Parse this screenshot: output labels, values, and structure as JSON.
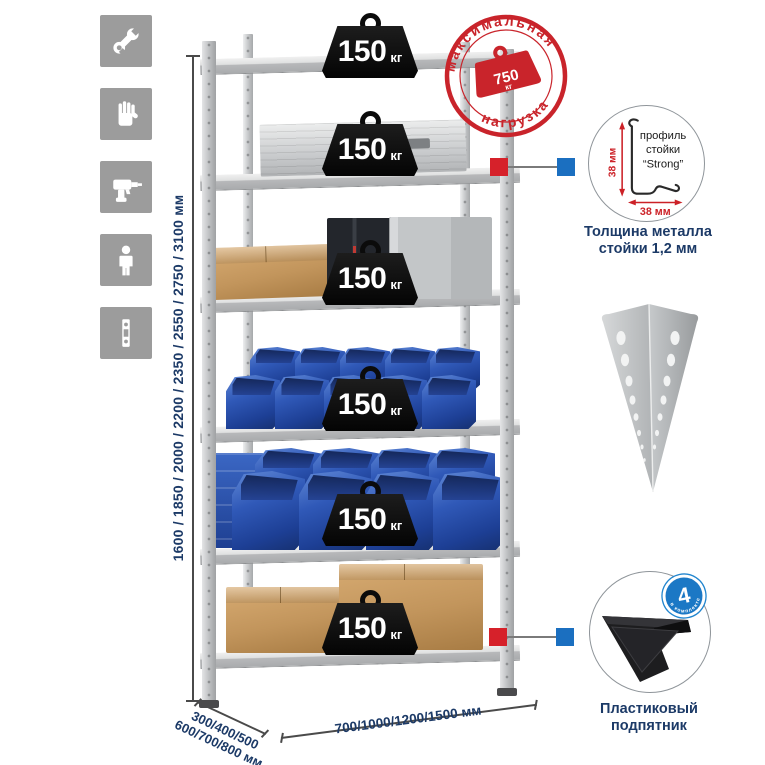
{
  "colors": {
    "accent_red": "#cc2127",
    "accent_blue": "#1b78c5",
    "navy_text": "#1c3a67",
    "icon_tile_gray": "#9c9c9c",
    "bin_blue": "#2c59b4",
    "cardboard_tan": "#c2955c"
  },
  "left_icons": [
    "wrench",
    "gloves",
    "drill",
    "person",
    "rack-post"
  ],
  "height_dim": {
    "label": "1600 / 1850 / 2000 / 2200 / 2350 / 2550 / 2750 / 3100 мм"
  },
  "stamp": {
    "arc_top": "максимальная",
    "arc_bottom": "нагрузка",
    "value": "750",
    "unit": "кг"
  },
  "shelves": [
    {
      "load": "150",
      "unit": "кг"
    },
    {
      "load": "150",
      "unit": "кг"
    },
    {
      "load": "150",
      "unit": "кг"
    },
    {
      "load": "150",
      "unit": "кг"
    },
    {
      "load": "150",
      "unit": "кг"
    },
    {
      "load": "150",
      "unit": "кг"
    }
  ],
  "profile_detail": {
    "line1": "профиль",
    "line2": "стойки",
    "line3": "“Strong”",
    "dim_vertical": "38 мм",
    "dim_horizontal": "38 мм",
    "caption_line1": "Толщина металла",
    "caption_line2": "стойки 1,2 мм"
  },
  "foot_detail": {
    "badge_number": "4",
    "badge_text": "в комплекте",
    "caption_line1": "Пластиковый",
    "caption_line2": "подпятник"
  },
  "depth_dim": {
    "line1": "300/400/500",
    "line2": "600/700/800 мм"
  },
  "width_dim": {
    "label": "700/1000/1200/1500 мм"
  }
}
